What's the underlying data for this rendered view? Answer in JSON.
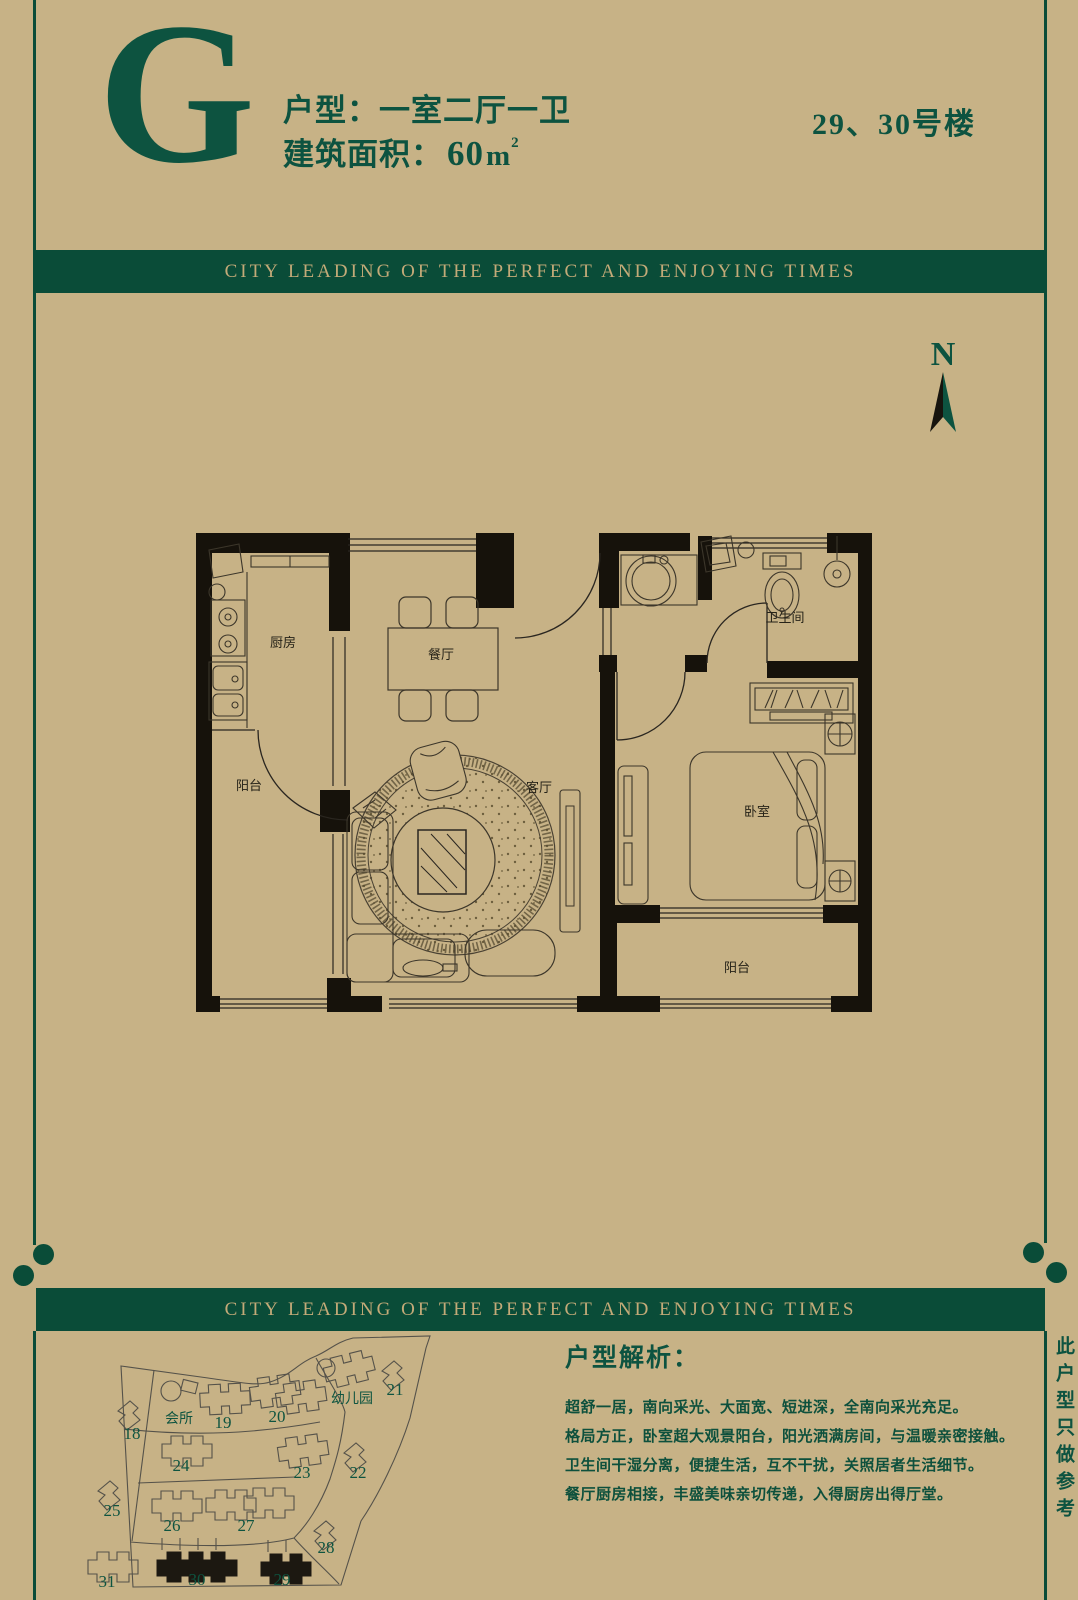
{
  "header": {
    "unit_letter": "G",
    "unit_type": "户型：一室二厅一卫",
    "area_label": "建筑面积：",
    "area_value": "60",
    "area_unit": "m",
    "area_exponent": "2",
    "building_number": "29、30号楼"
  },
  "banner": {
    "text": "CITY LEADING OF THE PERFECT AND ENJOYING TIMES"
  },
  "compass": {
    "label": "N"
  },
  "floorplan": {
    "labels": {
      "kitchen": "厨房",
      "dining": "餐厅",
      "kitchen_balcony": "阳台",
      "living": "客厅",
      "bathroom": "卫生间",
      "bedroom": "卧室",
      "bedroom_balcony": "阳台"
    }
  },
  "sitemap": {
    "clubhouse": "会所",
    "kindergarten": "幼儿园",
    "buildings": [
      {
        "label": "18",
        "highlighted": false
      },
      {
        "label": "19",
        "highlighted": false
      },
      {
        "label": "20",
        "highlighted": false
      },
      {
        "label": "21",
        "highlighted": false
      },
      {
        "label": "22",
        "highlighted": false
      },
      {
        "label": "23",
        "highlighted": false
      },
      {
        "label": "24",
        "highlighted": false
      },
      {
        "label": "25",
        "highlighted": false
      },
      {
        "label": "26",
        "highlighted": false
      },
      {
        "label": "27",
        "highlighted": false
      },
      {
        "label": "28",
        "highlighted": false
      },
      {
        "label": "29",
        "highlighted": true
      },
      {
        "label": "30",
        "highlighted": true
      },
      {
        "label": "31",
        "highlighted": false
      }
    ]
  },
  "analysis": {
    "heading": "户型解析：",
    "lines": [
      "超舒一居，南向采光、大面宽、短进深，全南向采光充足。",
      "格局方正，卧室超大观景阳台，阳光洒满房间，与温暖亲密接触。",
      "卫生间干湿分离，便捷生活，互不干扰，关照居者生活细节。",
      "餐厅厨房相接，丰盛美味亲切传递，入得厨房出得厅堂。"
    ]
  },
  "side_note": "此户型只做参考",
  "colors": {
    "background": "#c7b286",
    "green": "#0a4c38",
    "banner_text": "#c3aa78"
  }
}
